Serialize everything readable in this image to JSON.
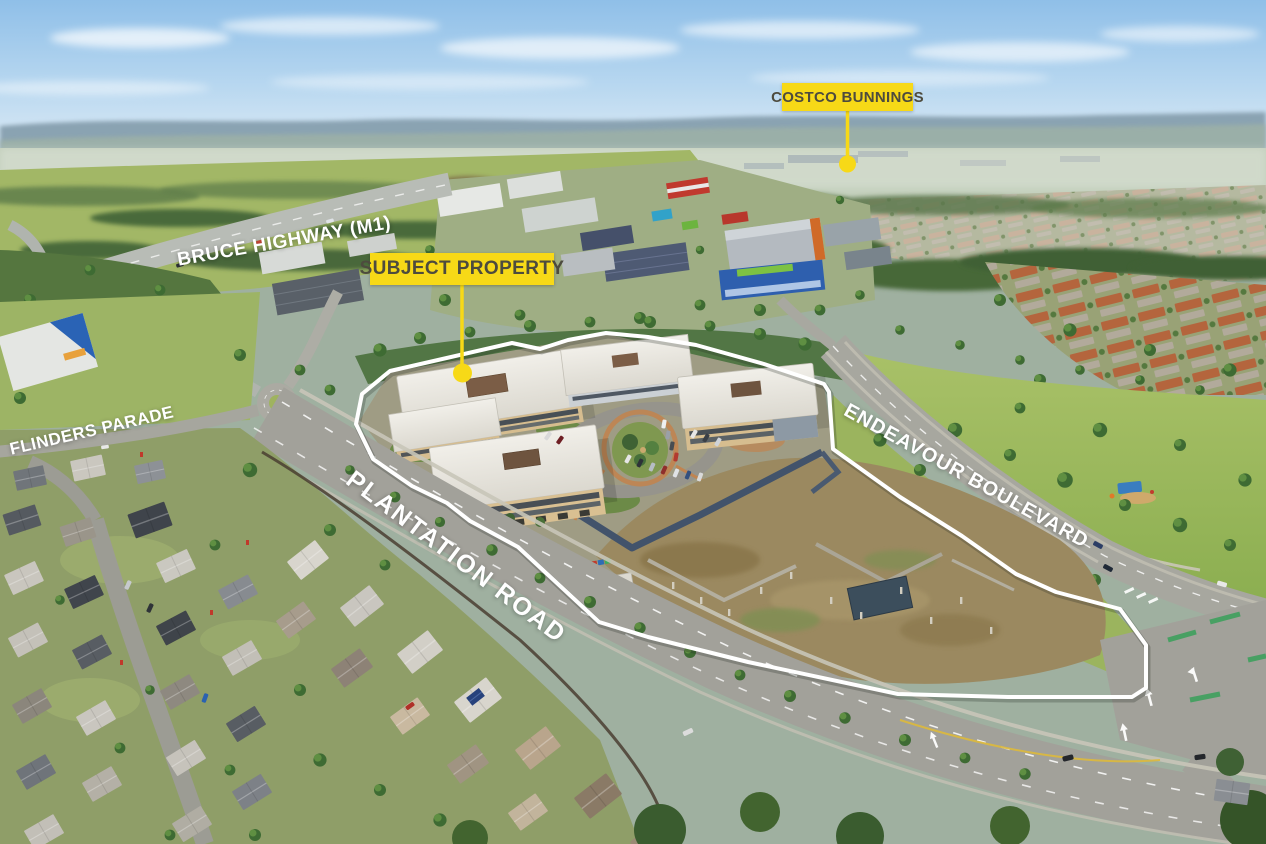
{
  "annotations": {
    "costco": {
      "label": "COSTCO BUNNINGS"
    },
    "subject_property": {
      "label": "SUBJECT PROPERTY"
    },
    "roads": [
      {
        "id": "bruce-highway-m1",
        "label": "BRUCE HIGHWAY (M1)"
      },
      {
        "id": "flinders-parade",
        "label": "FLINDERS PARADE"
      },
      {
        "id": "plantation-road",
        "label": "PLANTATION ROAD"
      },
      {
        "id": "endeavour-boulevard",
        "label": "ENDEAVOUR BOULEVARD"
      }
    ]
  },
  "colors": {
    "marker_background": "#F7D917",
    "marker_text": "#4D4B3E",
    "road_label_text": "#FFFFFF",
    "boundary_outline": "#FFFFFF"
  }
}
